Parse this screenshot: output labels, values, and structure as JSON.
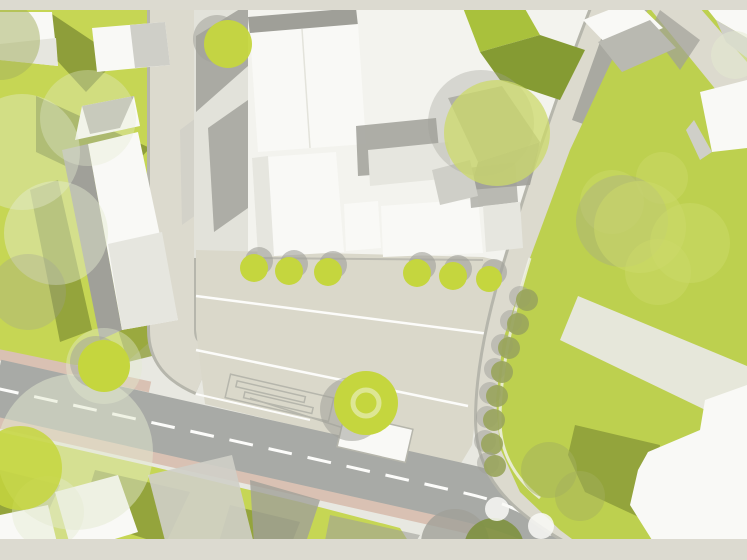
{
  "document": {
    "kind": "architectural-site-plan",
    "description": "Top-down urban site plan with buildings, streets, plaza, lawns and trees. No visible text labels."
  },
  "palette": {
    "bar": "#dcdad0",
    "ground": "#e8e8e1",
    "groundWhite": "#f3f3ee",
    "grass": "#c6d654",
    "grassRight": "#bdd04f",
    "grassShadow": "#8e9e3a",
    "greenRoofLight": "#a9c13c",
    "greenRoofDark": "#859b33",
    "street": "#dcdace",
    "streetSide": "#e2e2da",
    "plaza": "#dad8ca",
    "road": "#a8aaa6",
    "roadPink": "#d9c1b3",
    "lane": "#fcfcfa",
    "white": "#f9f9f6",
    "bldgFace": "#e6e6df",
    "bldgGray": "#cfcfc8",
    "roofGray": "#b9b9b1",
    "shadow": "#a0a099",
    "shadowDark": "#8f8f88",
    "curb": "#b6b6ac",
    "tree": "#c5d63e",
    "treeTrans": "#ccd96a",
    "treePale": "#e4ead0",
    "treeOlive": "#a3af5d",
    "treeOliveRow": "#99a45c",
    "treeDark": "#7e9140",
    "treeRing": "#dde694"
  },
  "roads": {
    "main_road": {
      "surface": "asphalt-gray",
      "centerline": "dashed-white",
      "edge_bands": "pink-sidewalk"
    },
    "left_street": {
      "surface": "light-beige"
    },
    "curved_street": {
      "surface": "light-beige"
    }
  },
  "trees": [
    {
      "x": 0,
      "y": 40,
      "r": 40,
      "f": "treeOlive",
      "o": 0.5
    },
    {
      "x": 22,
      "y": 152,
      "r": 58,
      "f": "treePale",
      "o": 0.4
    },
    {
      "x": 88,
      "y": 118,
      "r": 48,
      "f": "treePale",
      "o": 0.35
    },
    {
      "x": 56,
      "y": 233,
      "r": 52,
      "f": "treePale",
      "o": 0.45
    },
    {
      "x": 28,
      "y": 292,
      "r": 38,
      "f": "shadow",
      "o": 0.3
    },
    {
      "x": 104,
      "y": 366,
      "r": 38,
      "f": "treePale",
      "o": 0.4
    },
    {
      "x": 75,
      "y": 452,
      "r": 78,
      "f": "treePale",
      "o": 0.5
    },
    {
      "x": 48,
      "y": 512,
      "r": 36,
      "f": "treePale",
      "o": 0.4
    },
    {
      "x": 104,
      "y": 366,
      "r": 26,
      "f": "tree",
      "o": 1,
      "sdx": -8,
      "sdy": -4,
      "sop": 0.5
    },
    {
      "x": 20,
      "y": 468,
      "r": 42,
      "f": "tree",
      "o": 0.85
    },
    {
      "x": 228,
      "y": 44,
      "r": 24,
      "f": "tree",
      "o": 0.95,
      "sdx": -11,
      "sdy": -5,
      "sop": 0.55
    },
    {
      "x": 254,
      "y": 268,
      "r": 14,
      "f": "tree",
      "o": 1,
      "sdx": 5,
      "sdy": -7,
      "sop": 0.6
    },
    {
      "x": 289,
      "y": 271,
      "r": 14,
      "f": "tree",
      "o": 1,
      "sdx": 5,
      "sdy": -7,
      "sop": 0.6
    },
    {
      "x": 328,
      "y": 272,
      "r": 14,
      "f": "tree",
      "o": 1,
      "sdx": 5,
      "sdy": -7,
      "sop": 0.6
    },
    {
      "x": 417,
      "y": 273,
      "r": 14,
      "f": "tree",
      "o": 1,
      "sdx": 5,
      "sdy": -7,
      "sop": 0.6
    },
    {
      "x": 453,
      "y": 276,
      "r": 14,
      "f": "tree",
      "o": 1,
      "sdx": 5,
      "sdy": -7,
      "sop": 0.6
    },
    {
      "x": 489,
      "y": 279,
      "r": 13,
      "f": "tree",
      "o": 1,
      "sdx": 5,
      "sdy": -7,
      "sop": 0.6
    },
    {
      "x": 497,
      "y": 133,
      "r": 53,
      "f": "treeTrans",
      "o": 0.75,
      "sdx": -16,
      "sdy": -10,
      "sop": 0.35
    },
    {
      "x": 612,
      "y": 202,
      "r": 32,
      "f": "treeTrans",
      "o": 0.5
    },
    {
      "x": 662,
      "y": 178,
      "r": 26,
      "f": "treeTrans",
      "o": 0.45
    },
    {
      "x": 640,
      "y": 227,
      "r": 46,
      "f": "treeTrans",
      "o": 0.55,
      "sdx": -18,
      "sdy": -6,
      "sop": 0.3
    },
    {
      "x": 690,
      "y": 243,
      "r": 40,
      "f": "treeTrans",
      "o": 0.5
    },
    {
      "x": 658,
      "y": 272,
      "r": 33,
      "f": "treeTrans",
      "o": 0.45
    },
    {
      "x": 735,
      "y": 55,
      "r": 24,
      "f": "treePale",
      "o": 0.5
    },
    {
      "x": 527,
      "y": 300,
      "r": 11,
      "f": "treeOliveRow",
      "o": 0.9,
      "sdx": -7,
      "sdy": -3,
      "sop": 0.5
    },
    {
      "x": 518,
      "y": 324,
      "r": 11,
      "f": "treeOliveRow",
      "o": 0.9,
      "sdx": -7,
      "sdy": -3,
      "sop": 0.5
    },
    {
      "x": 509,
      "y": 348,
      "r": 11,
      "f": "treeOliveRow",
      "o": 0.9,
      "sdx": -7,
      "sdy": -3,
      "sop": 0.5
    },
    {
      "x": 502,
      "y": 372,
      "r": 11,
      "f": "treeOliveRow",
      "o": 0.9,
      "sdx": -7,
      "sdy": -3,
      "sop": 0.5
    },
    {
      "x": 497,
      "y": 396,
      "r": 11,
      "f": "treeOliveRow",
      "o": 0.9,
      "sdx": -7,
      "sdy": -3,
      "sop": 0.5
    },
    {
      "x": 494,
      "y": 420,
      "r": 11,
      "f": "treeOliveRow",
      "o": 0.9,
      "sdx": -7,
      "sdy": -3,
      "sop": 0.5
    },
    {
      "x": 492,
      "y": 444,
      "r": 11,
      "f": "treeOliveRow",
      "o": 0.9,
      "sdx": -7,
      "sdy": -3,
      "sop": 0.5
    },
    {
      "x": 495,
      "y": 466,
      "r": 11,
      "f": "treeOliveRow",
      "o": 0.9,
      "sdx": -7,
      "sdy": -3,
      "sop": 0.5
    },
    {
      "x": 549,
      "y": 470,
      "r": 28,
      "f": "treeOlive",
      "o": 0.5
    },
    {
      "x": 580,
      "y": 496,
      "r": 25,
      "f": "treeOlive",
      "o": 0.45
    },
    {
      "x": 366,
      "y": 403,
      "r": 32,
      "f": "tree",
      "o": 1,
      "sdx": -14,
      "sdy": 6,
      "sop": 0.55,
      "ring": true
    },
    {
      "x": 455,
      "y": 543,
      "r": 34,
      "f": "shadow",
      "o": 0.8
    },
    {
      "x": 494,
      "y": 548,
      "r": 30,
      "f": "treeDark",
      "o": 0.9
    },
    {
      "x": 497,
      "y": 509,
      "r": 12,
      "f": "white",
      "o": 0.85
    },
    {
      "x": 541,
      "y": 526,
      "r": 13,
      "f": "white",
      "o": 0.85
    }
  ]
}
